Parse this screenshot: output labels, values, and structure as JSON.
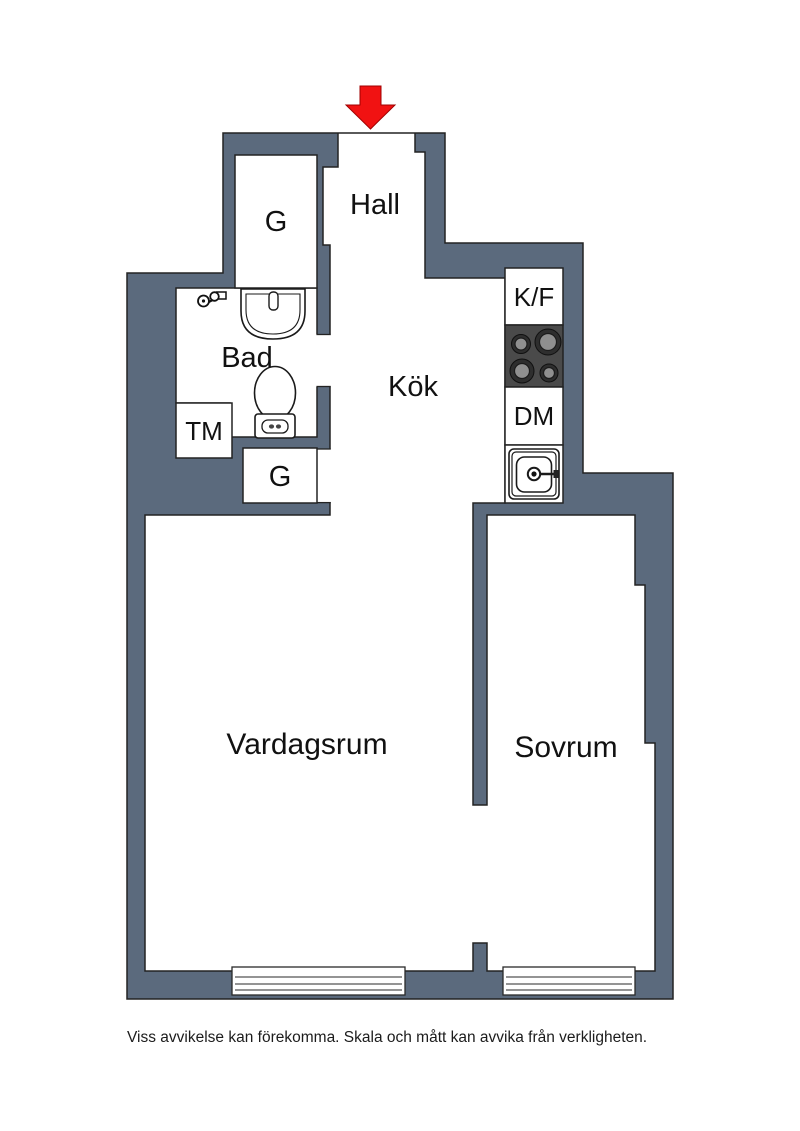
{
  "floorplan": {
    "disclaimer": "Viss avvikelse kan förekomma. Skala och mått kan avvika från verkligheten.",
    "colors": {
      "wall": "#5b6a7d",
      "arrow": "#f11212",
      "stove": "#4a4a4a"
    },
    "labels": {
      "hall": "Hall",
      "closet_top": "G",
      "bathroom": "Bad",
      "washing_machine": "TM",
      "closet_lower": "G",
      "kitchen": "Kök",
      "fridge_freezer": "K/F",
      "dishwasher": "DM",
      "living_room": "Vardagsrum",
      "bedroom": "Sovrum"
    },
    "icons": {
      "entrance": "entrance-arrow-icon",
      "fixtures": [
        "shower-mixer-icon",
        "washbasin-icon",
        "toilet-icon",
        "stove-burners-icon",
        "kitchen-sink-icon",
        "window-icon"
      ]
    }
  }
}
